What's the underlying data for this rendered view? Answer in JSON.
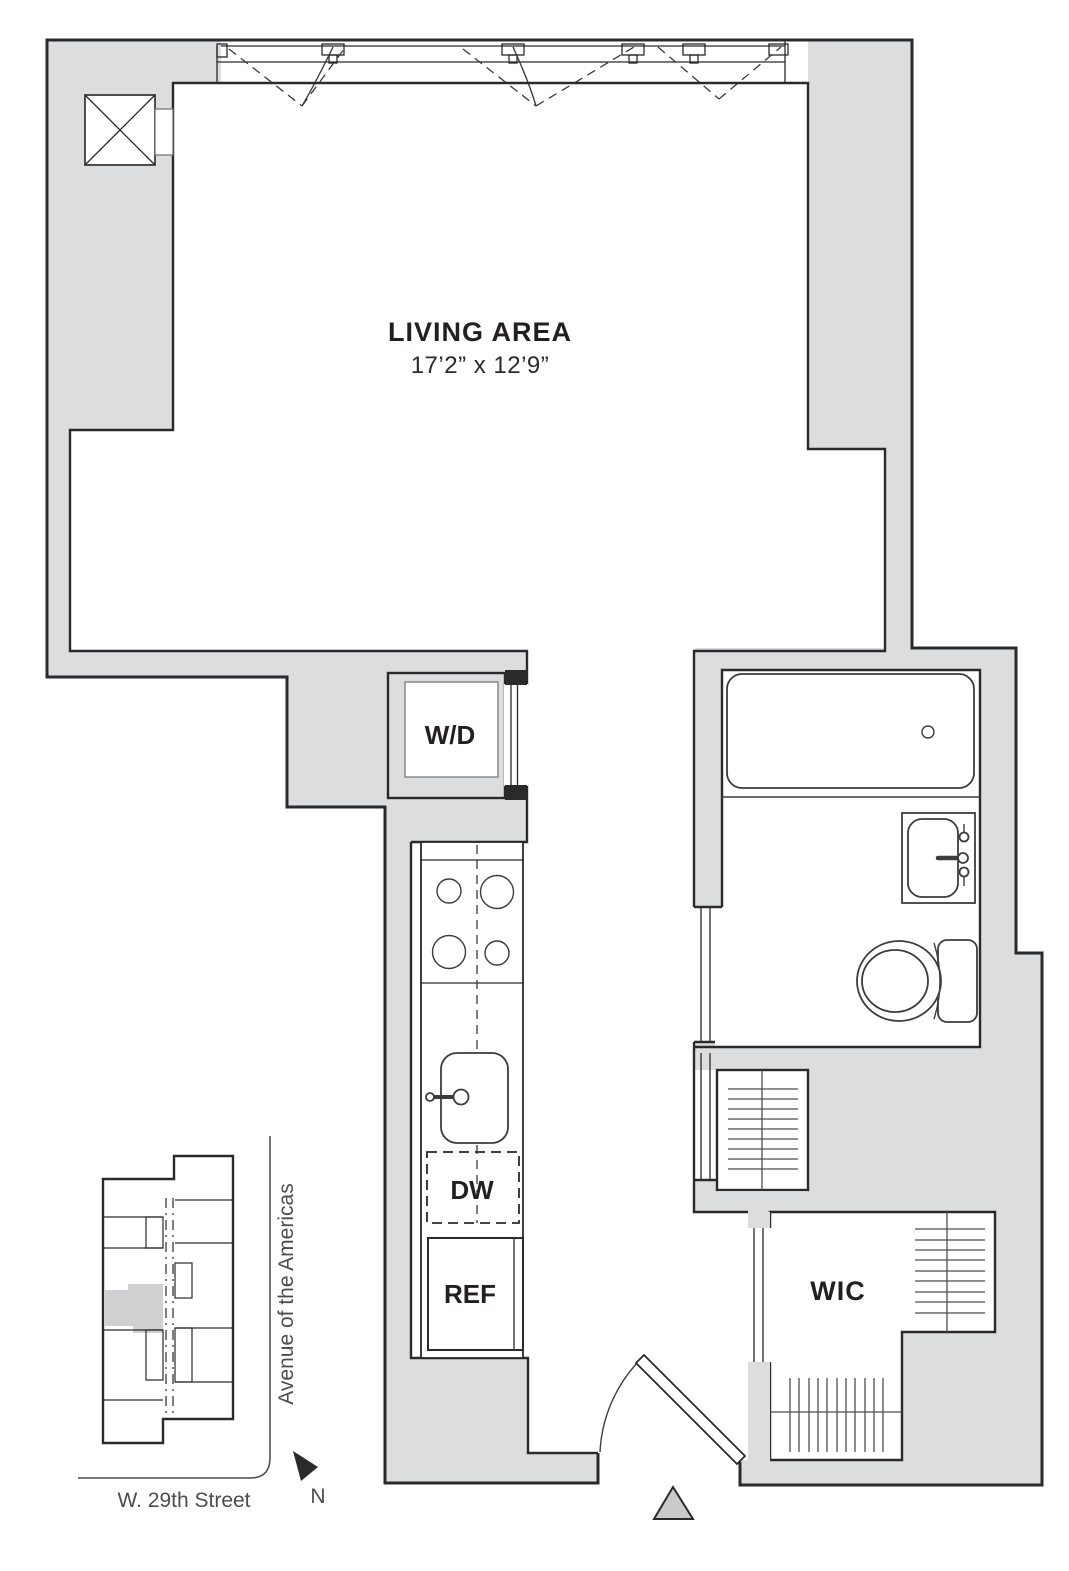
{
  "plan": {
    "living_area_label": "LIVING AREA",
    "living_area_dims": "17’2” x 12’9”",
    "washer_dryer_label": "W/D",
    "dishwasher_label": "DW",
    "refrigerator_label": "REF",
    "closet_label": "WIC"
  },
  "key_plan": {
    "avenue_label": "Avenue of the Americas",
    "street_label": "W. 29th Street",
    "north_label": "N"
  },
  "colors": {
    "wall_fill": "#dcddde",
    "outline": "#2a2a2c",
    "label_text": "#231f20",
    "street_text": "#4d4d4f"
  }
}
